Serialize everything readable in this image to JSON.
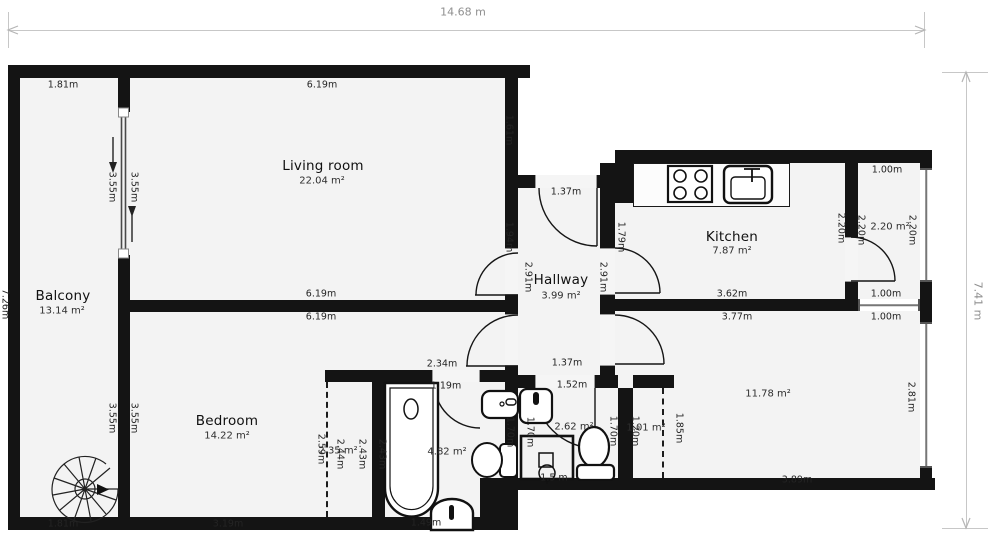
{
  "overall_dims": {
    "width_label": "14.68 m",
    "height_label": "7.41 m"
  },
  "rooms": [
    {
      "name": "Balcony",
      "area": "13.14 m²",
      "nx": 63,
      "ny": 296,
      "ax": 62,
      "ay": 311
    },
    {
      "name": "Living room",
      "area": "22.04 m²",
      "nx": 323,
      "ny": 166,
      "ax": 322,
      "ay": 181
    },
    {
      "name": "Bedroom",
      "area": "14.22 m²",
      "nx": 227,
      "ny": 421,
      "ax": 227,
      "ay": 436
    },
    {
      "name": "Hallway",
      "area": "3.99 m²",
      "nx": 561,
      "ny": 280,
      "ax": 561,
      "ay": 296
    },
    {
      "name": "Kitchen",
      "area": "7.87 m²",
      "nx": 732,
      "ny": 237,
      "ax": 732,
      "ay": 251
    }
  ],
  "area_labels": [
    {
      "t": "2.20 m²",
      "x": 890,
      "y": 227
    },
    {
      "t": "11.78 m²",
      "x": 768,
      "y": 394
    },
    {
      "t": "4.82 m²",
      "x": 447,
      "y": 452
    },
    {
      "t": "2.62 m²",
      "x": 574,
      "y": 427
    },
    {
      "t": "1.01 m²",
      "x": 646,
      "y": 428
    },
    {
      "t": "2.35 m²",
      "x": 338,
      "y": 451
    }
  ],
  "dim_labels": [
    {
      "t": "1.81m",
      "x": 63,
      "y": 85
    },
    {
      "t": "6.19m",
      "x": 322,
      "y": 85
    },
    {
      "t": "1.61m",
      "x": 509,
      "y": 130,
      "v": true
    },
    {
      "t": "3.55m",
      "x": 112,
      "y": 187,
      "v": true
    },
    {
      "t": "3.55m",
      "x": 134,
      "y": 187,
      "v": true
    },
    {
      "t": "1.37m",
      "x": 566,
      "y": 192
    },
    {
      "t": "1.94m",
      "x": 509,
      "y": 237,
      "v": true
    },
    {
      "t": "1.79m",
      "x": 621,
      "y": 237,
      "v": true
    },
    {
      "t": "2.91m",
      "x": 528,
      "y": 277,
      "v": true
    },
    {
      "t": "2.91m",
      "x": 603,
      "y": 277,
      "v": true
    },
    {
      "t": "2.20m",
      "x": 841,
      "y": 228,
      "v": true
    },
    {
      "t": "2.20m",
      "x": 861,
      "y": 230,
      "v": true
    },
    {
      "t": "2.20m",
      "x": 912,
      "y": 230,
      "v": true
    },
    {
      "t": "1.00m",
      "x": 887,
      "y": 170
    },
    {
      "t": "1.00m",
      "x": 886,
      "y": 294
    },
    {
      "t": "1.00m",
      "x": 886,
      "y": 317
    },
    {
      "t": "7.26m",
      "x": 5,
      "y": 304,
      "v": true
    },
    {
      "t": "3.55m",
      "x": 112,
      "y": 418,
      "v": true
    },
    {
      "t": "3.55m",
      "x": 134,
      "y": 418,
      "v": true
    },
    {
      "t": "6.19m",
      "x": 321,
      "y": 294
    },
    {
      "t": "6.19m",
      "x": 321,
      "y": 317
    },
    {
      "t": "3.62m",
      "x": 732,
      "y": 294
    },
    {
      "t": "3.77m",
      "x": 737,
      "y": 317
    },
    {
      "t": "1.37m",
      "x": 567,
      "y": 363
    },
    {
      "t": "2.34m",
      "x": 442,
      "y": 364
    },
    {
      "t": "1.19m",
      "x": 446,
      "y": 386
    },
    {
      "t": "1.52m",
      "x": 572,
      "y": 385
    },
    {
      "t": "2.59m",
      "x": 321,
      "y": 449,
      "v": true
    },
    {
      "t": "2.44m",
      "x": 340,
      "y": 454,
      "v": true
    },
    {
      "t": "2.43m",
      "x": 362,
      "y": 454,
      "v": true
    },
    {
      "t": "2.43m",
      "x": 382,
      "y": 454,
      "v": true
    },
    {
      "t": "1.70m",
      "x": 510,
      "y": 432,
      "v": true
    },
    {
      "t": "1.70m",
      "x": 530,
      "y": 432,
      "v": true
    },
    {
      "t": "1.70m",
      "x": 613,
      "y": 431,
      "v": true
    },
    {
      "t": "1.20m",
      "x": 635,
      "y": 431,
      "v": true
    },
    {
      "t": "1.85m",
      "x": 679,
      "y": 428,
      "v": true
    },
    {
      "t": "2.81m",
      "x": 911,
      "y": 397,
      "v": true
    },
    {
      "t": "1.5 m",
      "x": 554,
      "y": 478
    },
    {
      "t": "1.49m",
      "x": 426,
      "y": 523
    },
    {
      "t": "3.19m",
      "x": 228,
      "y": 524
    },
    {
      "t": "1.81m",
      "x": 63,
      "y": 524
    },
    {
      "t": "3.89m",
      "x": 797,
      "y": 480
    }
  ],
  "colors": {
    "wall": "#141414",
    "floor": "#f3f3f3",
    "dim_text": "#242424",
    "overall_dim_text": "#8f8f8f"
  }
}
